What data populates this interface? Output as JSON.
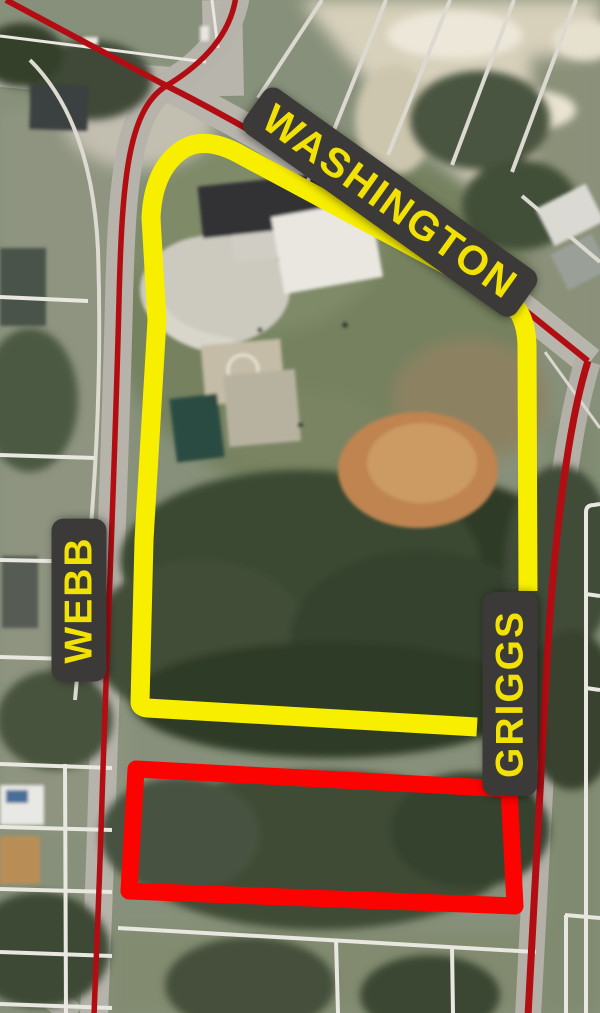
{
  "map": {
    "description": "Aerial parcel map with a park boundary highlighted in yellow and an adjacent parcel outlined in red",
    "street_labels": [
      {
        "id": "washington",
        "text": "WASHINGTON"
      },
      {
        "id": "webb",
        "text": "WEBB"
      },
      {
        "id": "griggs",
        "text": "GRIGGS"
      }
    ],
    "colors": {
      "park_outline": "#F8EE00",
      "highlight_parcel": "#FB0300",
      "street_line": "#B10D13",
      "label_bg": "#3B3A38",
      "label_text": "#F2E104"
    }
  }
}
